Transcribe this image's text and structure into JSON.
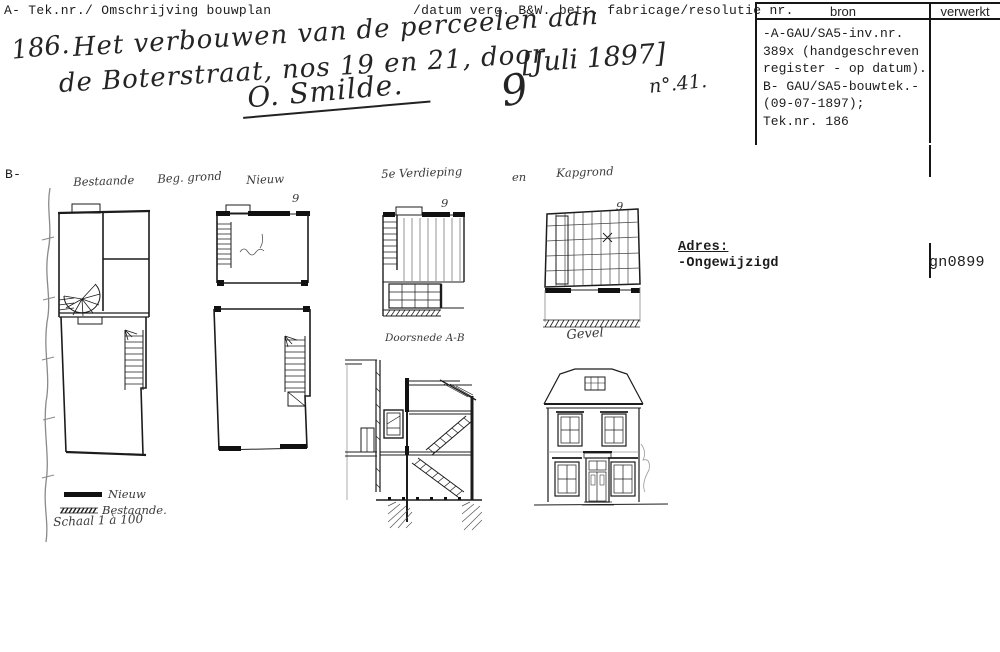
{
  "header": {
    "left": "A- Tek.nr./ Omschrijving bouwplan",
    "right": "/datum verg. B&W. betr. fabricage/resolutie nr."
  },
  "register": {
    "col_bron": "bron",
    "col_verwerkt": "verwerkt",
    "bron_lines": [
      "-A-GAU/SA5-inv.nr.",
      "389x (handgeschreven",
      "register - op datum).",
      "B- GAU/SA5-bouwtek.-",
      "(09-07-1897);",
      "Tek.nr. 186"
    ],
    "code": "gn0899"
  },
  "title": {
    "number": "186.",
    "line1": "Het verbouwen van de perceelen aan",
    "line2": "de Boterstraat, nos 19 en 21, door",
    "signature": "O. Smilde.",
    "day": "9",
    "date_bracket": "[Juli 1897]",
    "resolutie": "n°.41."
  },
  "section_marker": "B-",
  "plan_labels": {
    "bestaande": "Bestaande",
    "beg_grond": "Beg. grond",
    "nieuw": "Nieuw",
    "verdieping": "5e Verdieping",
    "en": "en",
    "kapgrond": "Kapgrond",
    "doorsnede": "Doorsnede A-B",
    "gevel": "Gevel"
  },
  "plan_marks": [
    "9",
    "9",
    "9"
  ],
  "legend": {
    "nieuw": "Nieuw",
    "bestaande": "Bestaande.",
    "schaal": "Schaal 1 à 100"
  },
  "adres": {
    "label": "Adres:",
    "value": "-Ongewijzigd"
  },
  "colors": {
    "ink": "#1c1c1c",
    "faint": "#777777"
  }
}
